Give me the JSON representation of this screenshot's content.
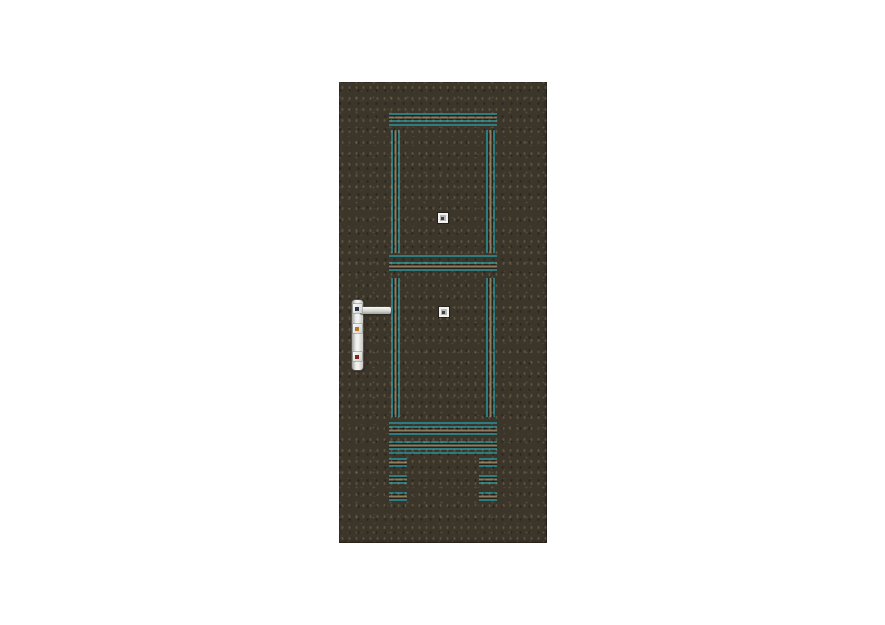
{
  "scene": {
    "background_color": "#ffffff",
    "subject": "metal entry door with grooved panel pattern and handle"
  },
  "door": {
    "finish": "dark olive-brown speckled powder coat",
    "panel_count": 2,
    "stud_count": 2,
    "short_groove_rows": 3,
    "groove_style": "teal and tan accent lines"
  },
  "hardware": {
    "parts": [
      "handle-backplate",
      "lever-handle",
      "handle-rose",
      "cylinder-upper",
      "keyhole-lower"
    ],
    "plate_finish": "brushed silver"
  },
  "theme": {
    "canvas_bg": "#ffffff",
    "door_base": "#3b352a",
    "groove_teal": "#2e7b80",
    "groove_tan": "#8c7b5e",
    "groove_shadow": "#26221a",
    "metal_border": "#6f6f69",
    "rose_dot": "#2c3450",
    "cylinder_dot": "#b5772b",
    "keyhole_dot": "#7c2722",
    "stud_outer": "#f2f2f0",
    "stud_inner": "#b9b8b6",
    "stud_dot": "#3f3f46"
  }
}
